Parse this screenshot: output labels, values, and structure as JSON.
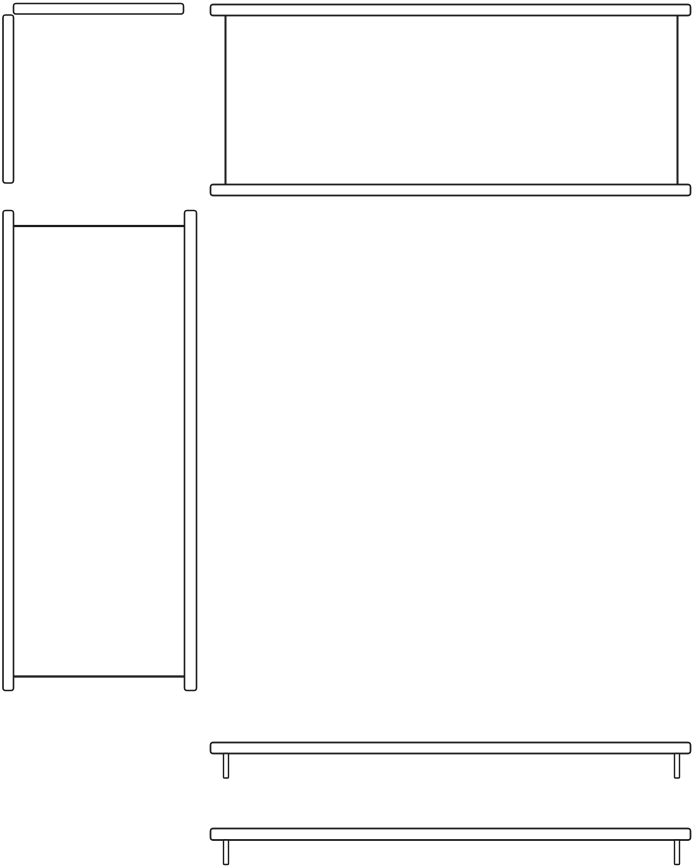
{
  "meta": {
    "title": "Technical line drawing of furniture parts (orthographic views)",
    "description": "Black outline drawing on white background: a corner edge view (top left), a front view of a table/bench with top plank, two legs and bottom plank (top right), a tall side view with two vertical panels joined by top and bottom edge lines (middle left), and two side views of a plank with two short legs (bottom right)."
  },
  "canvas": {
    "width": 697,
    "height": 867,
    "background": "#ffffff",
    "line_color": "#1b1b1b",
    "fill_color": "#ffffff"
  },
  "figures": [
    {
      "name": "corner-edge-view",
      "shapes": [
        {
          "kind": "rect",
          "name": "top-strip",
          "x": 13.5,
          "y": 3.5,
          "w": 170,
          "h": 10.5,
          "rx": 2.5,
          "sw": 1.6
        },
        {
          "kind": "rect",
          "name": "left-strip",
          "x": 3,
          "y": 15,
          "w": 10.5,
          "h": 168,
          "rx": 2.5,
          "sw": 1.6
        }
      ]
    },
    {
      "name": "front-view",
      "shapes": [
        {
          "kind": "rect",
          "name": "top-plank",
          "x": 210.5,
          "y": 4.5,
          "w": 480,
          "h": 11,
          "rx": 2.5,
          "sw": 1.7
        },
        {
          "kind": "line",
          "name": "left-leg",
          "x1": 225.5,
          "y1": 15.5,
          "x2": 225.5,
          "y2": 184.5,
          "sw": 2
        },
        {
          "kind": "line",
          "name": "right-leg",
          "x1": 677.5,
          "y1": 15.5,
          "x2": 677.5,
          "y2": 184.5,
          "sw": 2
        },
        {
          "kind": "rect",
          "name": "bottom-plank",
          "x": 210.5,
          "y": 184.5,
          "w": 480,
          "h": 11,
          "rx": 2.5,
          "sw": 1.7
        }
      ]
    },
    {
      "name": "side-view",
      "shapes": [
        {
          "kind": "rect",
          "name": "left-panel",
          "x": 3,
          "y": 210.5,
          "w": 10.5,
          "h": 480,
          "rx": 2.5,
          "sw": 1.6
        },
        {
          "kind": "rect",
          "name": "right-panel",
          "x": 184.5,
          "y": 210.5,
          "w": 12,
          "h": 480,
          "rx": 2.5,
          "sw": 1.6
        },
        {
          "kind": "line",
          "name": "top-surface-edge",
          "x1": 13.5,
          "y1": 226,
          "x2": 184.5,
          "y2": 226,
          "sw": 2.2
        },
        {
          "kind": "line",
          "name": "bottom-shelf-edge",
          "x1": 13.5,
          "y1": 676.5,
          "x2": 184.5,
          "y2": 676.5,
          "sw": 2.2
        }
      ]
    },
    {
      "name": "shelf-side-view-upper",
      "shapes": [
        {
          "kind": "rect",
          "name": "plank",
          "x": 210.5,
          "y": 742.5,
          "w": 480,
          "h": 11,
          "rx": 2.5,
          "sw": 1.7
        },
        {
          "kind": "rect",
          "name": "left-leg",
          "x": 223.5,
          "y": 753.5,
          "w": 5,
          "h": 24.5,
          "rx": 1,
          "sw": 1.4
        },
        {
          "kind": "rect",
          "name": "right-leg",
          "x": 674.5,
          "y": 753.5,
          "w": 5,
          "h": 24.5,
          "rx": 1,
          "sw": 1.4
        }
      ]
    },
    {
      "name": "shelf-side-view-lower",
      "shapes": [
        {
          "kind": "rect",
          "name": "plank",
          "x": 210.5,
          "y": 828.5,
          "w": 480,
          "h": 11.5,
          "rx": 2.5,
          "sw": 1.7
        },
        {
          "kind": "rect",
          "name": "left-leg",
          "x": 223.5,
          "y": 840,
          "w": 5,
          "h": 24.5,
          "rx": 1,
          "sw": 1.4
        },
        {
          "kind": "rect",
          "name": "right-leg",
          "x": 674.5,
          "y": 840,
          "w": 5,
          "h": 24.5,
          "rx": 1,
          "sw": 1.4
        }
      ]
    }
  ]
}
